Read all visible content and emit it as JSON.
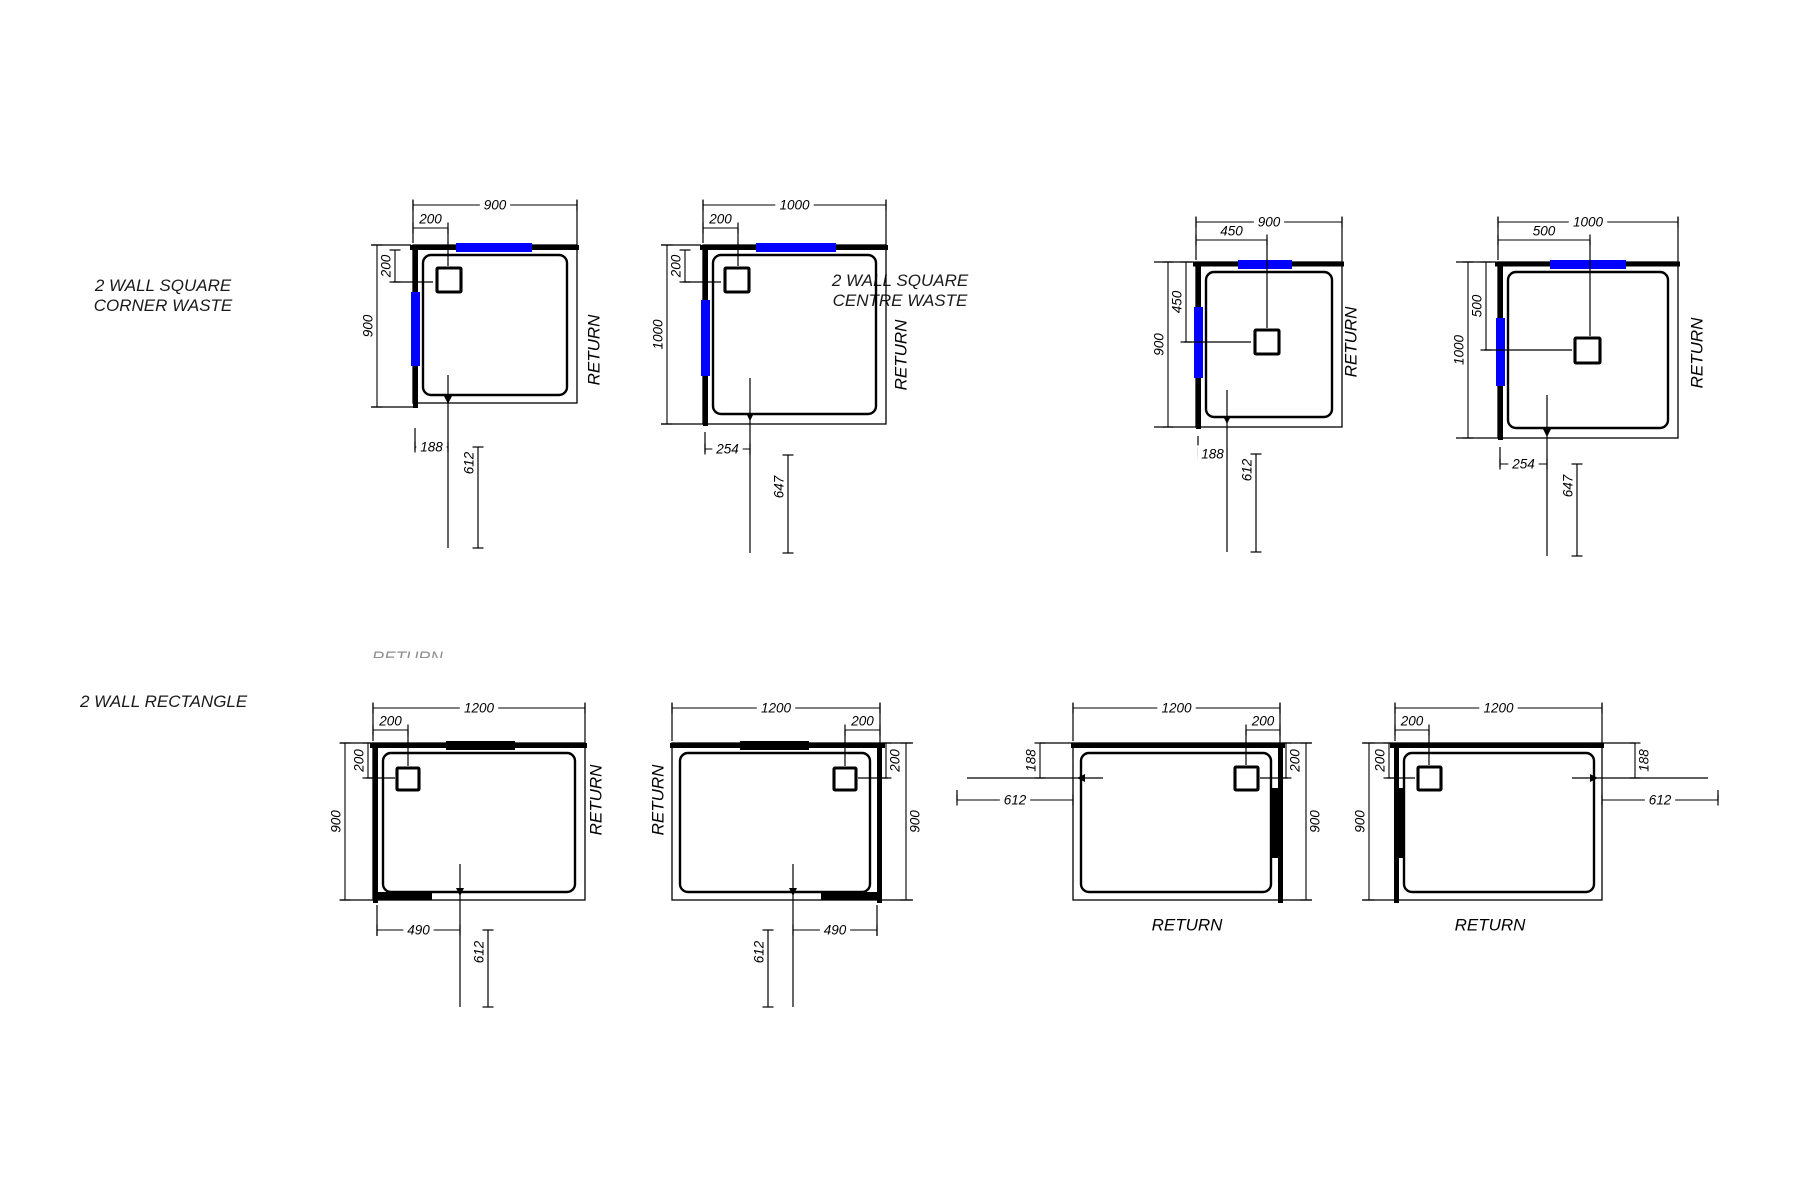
{
  "page": {
    "background": "#ffffff"
  },
  "colors": {
    "line": "#000000",
    "glass_blue": "#0000ff",
    "glass_black": "#000000",
    "text": "#000000"
  },
  "sections": {
    "corner": {
      "title_line1": "2 WALL SQUARE",
      "title_line2": "CORNER WASTE"
    },
    "centre": {
      "title_line1": "2 WALL SQUARE",
      "title_line2": "CENTRE WASTE"
    },
    "rectangle": {
      "title_line1": "2 WALL RECTANGLE"
    }
  },
  "clipped_label": "RETURN",
  "diagrams": [
    {
      "id": "square-900-corner-waste",
      "return_label": "RETURN",
      "dims": {
        "width": "900",
        "offset_top": "200",
        "offset_side": "200",
        "height": "900",
        "bottom_a": "188",
        "bottom_b": "612"
      }
    },
    {
      "id": "square-1000-corner-waste",
      "return_label": "RETURN",
      "dims": {
        "width": "1000",
        "offset_top": "200",
        "offset_side": "200",
        "height": "1000",
        "bottom_a": "254",
        "bottom_b": "647"
      }
    },
    {
      "id": "square-900-centre-waste",
      "return_label": "RETURN",
      "dims": {
        "width": "900",
        "offset_top": "450",
        "offset_side": "450",
        "height": "900",
        "bottom_a": "188",
        "bottom_b": "612"
      }
    },
    {
      "id": "square-1000-centre-waste",
      "return_label": "RETURN",
      "dims": {
        "width": "1000",
        "offset_top": "500",
        "offset_side": "500",
        "height": "1000",
        "bottom_a": "254",
        "bottom_b": "647"
      }
    },
    {
      "id": "rect-1200-waste-left",
      "return_label": "RETURN",
      "dims": {
        "width": "1200",
        "offset_top": "200",
        "offset_side": "200",
        "height": "900",
        "bottom_a": "490",
        "bottom_b": "612"
      }
    },
    {
      "id": "rect-1200-waste-right",
      "return_label": "RETURN",
      "dims": {
        "width": "1200",
        "offset_top": "200",
        "offset_side": "200",
        "height": "900",
        "bottom_a": "490",
        "bottom_b": "612"
      }
    },
    {
      "id": "rect-1200-return-bottom-right-wall",
      "return_label": "RETURN",
      "dims": {
        "width": "1200",
        "offset_top": "200",
        "offset_side": "200",
        "height": "900",
        "side_a": "188",
        "side_b": "612"
      }
    },
    {
      "id": "rect-1200-return-bottom-left-wall",
      "return_label": "RETURN",
      "dims": {
        "width": "1200",
        "offset_top": "200",
        "offset_side": "200",
        "height": "900",
        "side_a": "188",
        "side_b": "612"
      }
    }
  ]
}
